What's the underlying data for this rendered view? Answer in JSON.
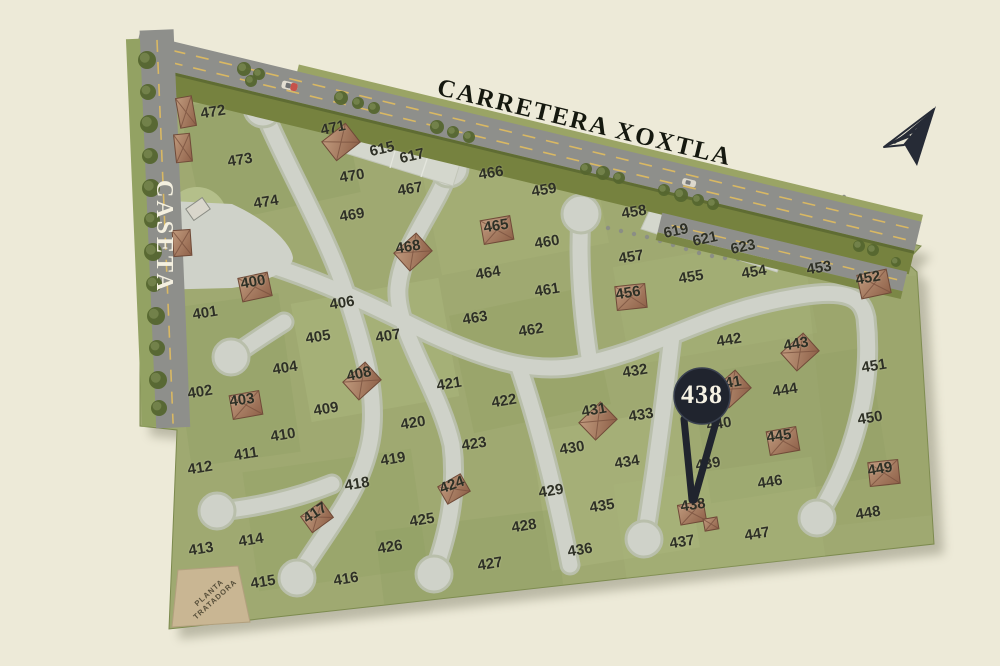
{
  "labels": {
    "highway": "CARRETERA XOXTLA",
    "gate": "CASETA",
    "treatment_plant": [
      "PLANTA",
      "TRATADORA"
    ]
  },
  "pin": {
    "label": "438",
    "color": "#20242e",
    "text_color": "#f6f2e4"
  },
  "compass": {
    "name": "north-arrow",
    "color": "#262b36"
  },
  "colors": {
    "background": "#edead8",
    "map_green": "#9fa971",
    "highway_gray": "#8e8f8b",
    "inner_road": "#cfd2c9",
    "inner_road_edge": "#b9bfab",
    "dash_yellow": "#d9b863",
    "roof_brown": "#a87c60",
    "parcel_tan": "#c9b693",
    "tree_green": "#5e6d38",
    "label_ink": "#2e3026"
  },
  "lots": [
    {
      "n": "472",
      "x": 213,
      "y": 112
    },
    {
      "n": "473",
      "x": 240,
      "y": 160
    },
    {
      "n": "474",
      "x": 266,
      "y": 202
    },
    {
      "n": "471",
      "x": 333,
      "y": 128,
      "r": -12
    },
    {
      "n": "470",
      "x": 352,
      "y": 176
    },
    {
      "n": "469",
      "x": 352,
      "y": 215
    },
    {
      "n": "615",
      "x": 382,
      "y": 149,
      "r": -13
    },
    {
      "n": "617",
      "x": 412,
      "y": 156,
      "r": -13
    },
    {
      "n": "467",
      "x": 410,
      "y": 189
    },
    {
      "n": "466",
      "x": 491,
      "y": 173
    },
    {
      "n": "468",
      "x": 408,
      "y": 247
    },
    {
      "n": "465",
      "x": 496,
      "y": 226
    },
    {
      "n": "459",
      "x": 544,
      "y": 190
    },
    {
      "n": "460",
      "x": 547,
      "y": 242
    },
    {
      "n": "458",
      "x": 634,
      "y": 212
    },
    {
      "n": "457",
      "x": 631,
      "y": 257
    },
    {
      "n": "619",
      "x": 676,
      "y": 231,
      "r": -12
    },
    {
      "n": "621",
      "x": 705,
      "y": 239,
      "r": -12
    },
    {
      "n": "623",
      "x": 743,
      "y": 247,
      "r": -12
    },
    {
      "n": "455",
      "x": 691,
      "y": 277
    },
    {
      "n": "454",
      "x": 754,
      "y": 272
    },
    {
      "n": "453",
      "x": 819,
      "y": 268
    },
    {
      "n": "452",
      "x": 868,
      "y": 278,
      "r": -10
    },
    {
      "n": "456",
      "x": 628,
      "y": 293
    },
    {
      "n": "464",
      "x": 488,
      "y": 273
    },
    {
      "n": "461",
      "x": 547,
      "y": 290
    },
    {
      "n": "463",
      "x": 475,
      "y": 318
    },
    {
      "n": "462",
      "x": 531,
      "y": 330
    },
    {
      "n": "400",
      "x": 253,
      "y": 282,
      "r": -10
    },
    {
      "n": "401",
      "x": 205,
      "y": 313
    },
    {
      "n": "406",
      "x": 342,
      "y": 303
    },
    {
      "n": "405",
      "x": 318,
      "y": 337
    },
    {
      "n": "407",
      "x": 388,
      "y": 336
    },
    {
      "n": "404",
      "x": 285,
      "y": 368
    },
    {
      "n": "402",
      "x": 200,
      "y": 392
    },
    {
      "n": "403",
      "x": 242,
      "y": 400,
      "r": -8
    },
    {
      "n": "408",
      "x": 359,
      "y": 374,
      "r": -12
    },
    {
      "n": "409",
      "x": 326,
      "y": 409
    },
    {
      "n": "421",
      "x": 449,
      "y": 384
    },
    {
      "n": "422",
      "x": 504,
      "y": 401
    },
    {
      "n": "410",
      "x": 283,
      "y": 435
    },
    {
      "n": "411",
      "x": 246,
      "y": 454
    },
    {
      "n": "412",
      "x": 200,
      "y": 468
    },
    {
      "n": "420",
      "x": 413,
      "y": 423
    },
    {
      "n": "423",
      "x": 474,
      "y": 444
    },
    {
      "n": "419",
      "x": 393,
      "y": 459
    },
    {
      "n": "418",
      "x": 357,
      "y": 484
    },
    {
      "n": "424",
      "x": 452,
      "y": 485,
      "r": -20
    },
    {
      "n": "425",
      "x": 422,
      "y": 520
    },
    {
      "n": "426",
      "x": 390,
      "y": 547
    },
    {
      "n": "413",
      "x": 201,
      "y": 549
    },
    {
      "n": "414",
      "x": 251,
      "y": 540
    },
    {
      "n": "415",
      "x": 263,
      "y": 582
    },
    {
      "n": "416",
      "x": 346,
      "y": 579
    },
    {
      "n": "417",
      "x": 315,
      "y": 513,
      "r": -33
    },
    {
      "n": "427",
      "x": 490,
      "y": 564
    },
    {
      "n": "428",
      "x": 524,
      "y": 526
    },
    {
      "n": "429",
      "x": 551,
      "y": 491
    },
    {
      "n": "430",
      "x": 572,
      "y": 448
    },
    {
      "n": "431",
      "x": 594,
      "y": 410,
      "r": -10
    },
    {
      "n": "432",
      "x": 635,
      "y": 371
    },
    {
      "n": "433",
      "x": 641,
      "y": 415
    },
    {
      "n": "434",
      "x": 627,
      "y": 462
    },
    {
      "n": "435",
      "x": 602,
      "y": 506
    },
    {
      "n": "436",
      "x": 580,
      "y": 550
    },
    {
      "n": "437",
      "x": 682,
      "y": 542
    },
    {
      "n": "442",
      "x": 729,
      "y": 340
    },
    {
      "n": "443",
      "x": 796,
      "y": 344,
      "r": -10
    },
    {
      "n": "441",
      "x": 729,
      "y": 383,
      "r": -10
    },
    {
      "n": "444",
      "x": 785,
      "y": 390
    },
    {
      "n": "451",
      "x": 874,
      "y": 366
    },
    {
      "n": "440",
      "x": 719,
      "y": 424
    },
    {
      "n": "445",
      "x": 779,
      "y": 436,
      "r": -8
    },
    {
      "n": "450",
      "x": 870,
      "y": 418
    },
    {
      "n": "439",
      "x": 708,
      "y": 464
    },
    {
      "n": "446",
      "x": 770,
      "y": 482
    },
    {
      "n": "449",
      "x": 880,
      "y": 469,
      "r": -10
    },
    {
      "n": "448",
      "x": 868,
      "y": 513
    },
    {
      "n": "447",
      "x": 757,
      "y": 534
    },
    {
      "n": "438",
      "x": 693,
      "y": 505,
      "r": -8
    }
  ],
  "houses": [
    {
      "x": 186,
      "y": 112,
      "r": -10,
      "w": 16,
      "h": 30
    },
    {
      "x": 183,
      "y": 148,
      "r": -6,
      "w": 16,
      "h": 28
    },
    {
      "x": 182,
      "y": 243,
      "r": -4,
      "w": 18,
      "h": 26
    },
    {
      "x": 198,
      "y": 209,
      "r": -35,
      "w": 20,
      "h": 14,
      "light": true
    },
    {
      "x": 341,
      "y": 142,
      "r": -38
    },
    {
      "x": 497,
      "y": 230,
      "r": -10
    },
    {
      "x": 413,
      "y": 252,
      "r": -42
    },
    {
      "x": 255,
      "y": 287,
      "r": -12
    },
    {
      "x": 246,
      "y": 405,
      "r": -10
    },
    {
      "x": 362,
      "y": 381,
      "r": -42
    },
    {
      "x": 317,
      "y": 517,
      "r": -36,
      "w": 26,
      "h": 20
    },
    {
      "x": 454,
      "y": 489,
      "r": -30,
      "w": 26,
      "h": 20
    },
    {
      "x": 631,
      "y": 297,
      "r": -6
    },
    {
      "x": 874,
      "y": 284,
      "r": -12
    },
    {
      "x": 598,
      "y": 421,
      "r": -44
    },
    {
      "x": 800,
      "y": 352,
      "r": -42
    },
    {
      "x": 732,
      "y": 389,
      "r": -42
    },
    {
      "x": 783,
      "y": 441,
      "r": -10
    },
    {
      "x": 884,
      "y": 473,
      "r": -6
    },
    {
      "x": 692,
      "y": 513,
      "r": -10,
      "w": 26,
      "h": 20
    },
    {
      "x": 711,
      "y": 524,
      "r": -10,
      "w": 14,
      "h": 12
    }
  ],
  "trees": [
    [
      147,
      60,
      9
    ],
    [
      148,
      92,
      8
    ],
    [
      149,
      124,
      9
    ],
    [
      150,
      156,
      8
    ],
    [
      151,
      188,
      9
    ],
    [
      152,
      220,
      8
    ],
    [
      153,
      252,
      9
    ],
    [
      154,
      284,
      8
    ],
    [
      156,
      316,
      9
    ],
    [
      157,
      348,
      8
    ],
    [
      158,
      380,
      9
    ],
    [
      159,
      408,
      8
    ],
    [
      244,
      69,
      7
    ],
    [
      259,
      74,
      6
    ],
    [
      251,
      81,
      6
    ],
    [
      341,
      98,
      7
    ],
    [
      358,
      103,
      6
    ],
    [
      374,
      108,
      6
    ],
    [
      437,
      127,
      7
    ],
    [
      453,
      132,
      6
    ],
    [
      469,
      137,
      6
    ],
    [
      586,
      169,
      6
    ],
    [
      603,
      173,
      7
    ],
    [
      619,
      178,
      6
    ],
    [
      664,
      190,
      6
    ],
    [
      681,
      195,
      7
    ],
    [
      698,
      200,
      6
    ],
    [
      713,
      204,
      6
    ],
    [
      859,
      246,
      6
    ],
    [
      873,
      250,
      6
    ],
    [
      896,
      262,
      5
    ]
  ],
  "footpath_dots": [
    [
      608,
      228
    ],
    [
      621,
      231
    ],
    [
      634,
      234
    ],
    [
      647,
      237
    ],
    [
      660,
      241
    ],
    [
      673,
      245
    ],
    [
      686,
      249
    ],
    [
      699,
      253
    ],
    [
      712,
      256
    ],
    [
      725,
      258
    ],
    [
      738,
      259
    ],
    [
      751,
      258
    ],
    [
      763,
      255
    ],
    [
      776,
      250
    ],
    [
      788,
      243
    ],
    [
      800,
      235
    ],
    [
      812,
      226
    ],
    [
      823,
      216
    ],
    [
      834,
      206
    ],
    [
      844,
      197
    ]
  ]
}
